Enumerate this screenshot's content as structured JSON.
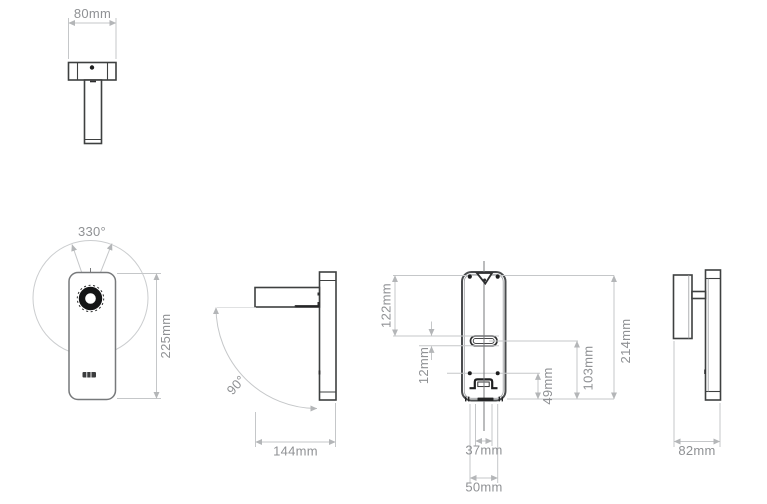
{
  "drawing": {
    "views": {
      "top": {
        "width": "80mm"
      },
      "front": {
        "rotation": "330°",
        "height": "225mm"
      },
      "side_open": {
        "swing": "90°",
        "projection": "144mm"
      },
      "back": {
        "top_to_slot": "122mm",
        "slot_height": "12mm",
        "bracket_width": "37mm",
        "hole_spacing": "50mm",
        "holes_to_bottom": "49mm",
        "slot_to_bottom": "103mm",
        "mount_height": "214mm"
      },
      "side_closed": {
        "depth": "82mm"
      }
    },
    "colors": {
      "background": "#ffffff",
      "outline_dark": "#3e4040",
      "outline_front": "#77797b",
      "dimension_line": "#c5c7c9",
      "dimension_text": "#8f9194",
      "detail_black": "#1d1e1f"
    }
  }
}
